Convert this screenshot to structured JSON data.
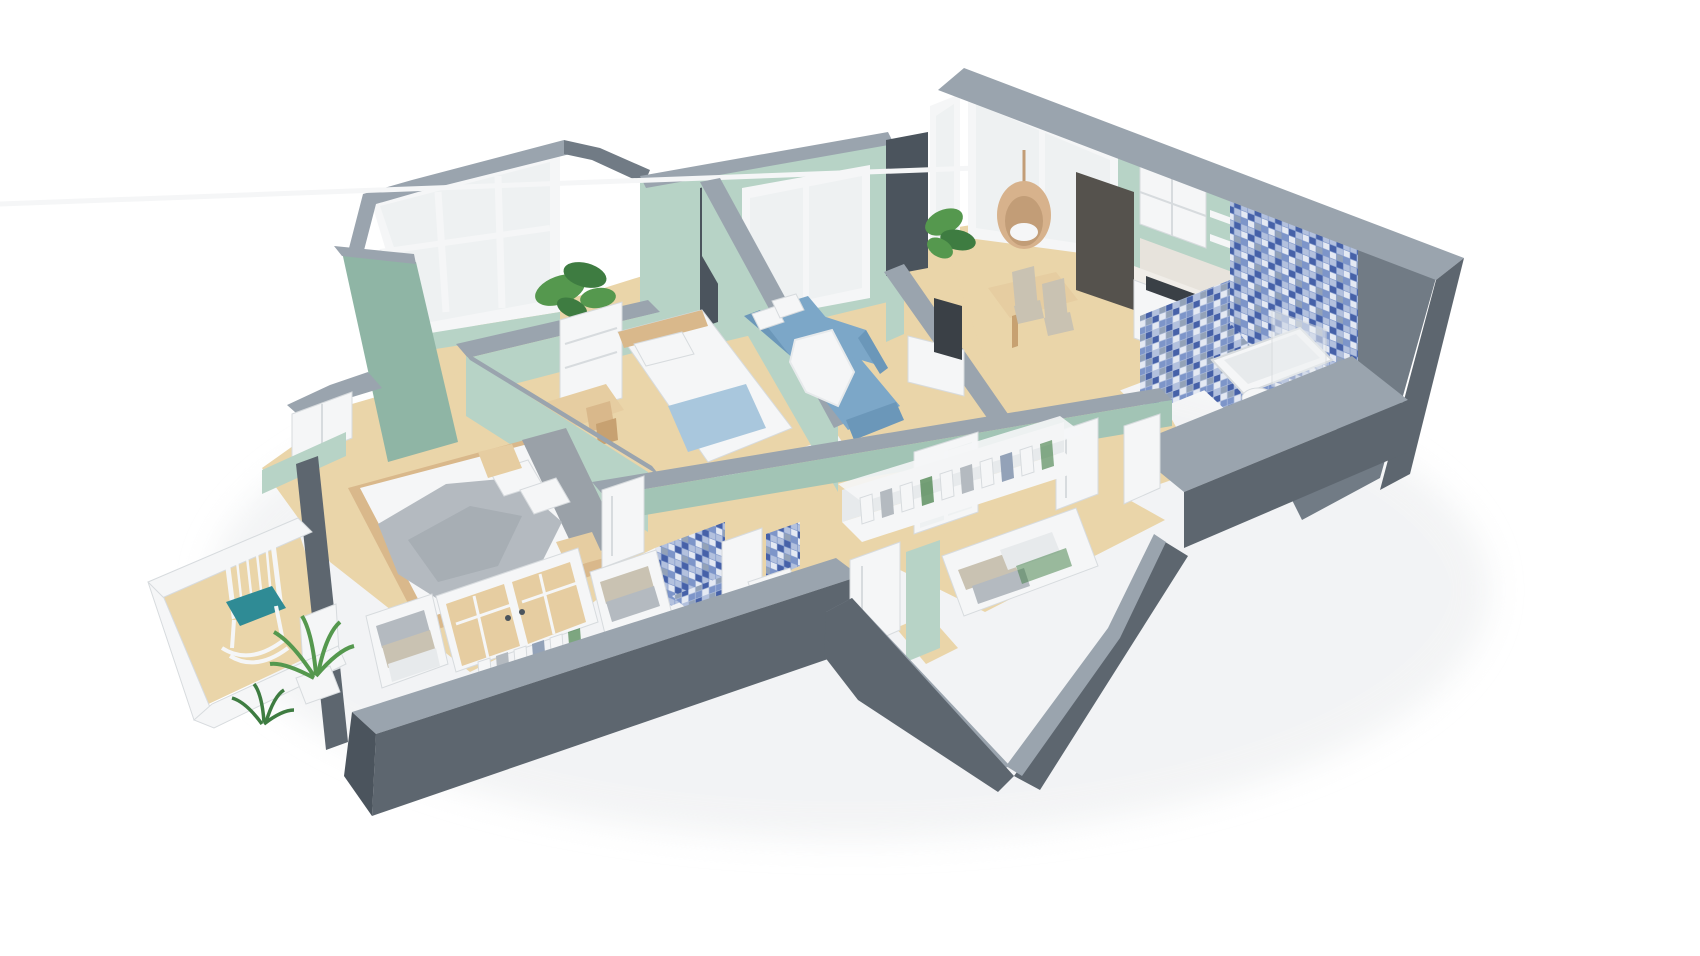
{
  "meta": {
    "title": "3D isometric cutaway floor plan render of an apartment",
    "view": "axonometric bird's-eye, cut walls, white studio background",
    "visible_text": "none"
  },
  "palette": {
    "bg": "#ffffff",
    "shadow": "#e9ebed",
    "wall_top": "#9aa4ae",
    "wall_top_light": "#aab3bc",
    "wall_front": "#5d666f",
    "wall_side": "#717b85",
    "wall_dark": "#4b545d",
    "mint": "#b7d3c6",
    "mint_light": "#c9e0d3",
    "mint_dark": "#a2c4b5",
    "mint_deep": "#8fb5a5",
    "floor": "#ead5a9",
    "floor_dark": "#ddc08f",
    "white": "#f5f6f7",
    "white_dim": "#e7eaec",
    "frame_stroke": "#d7dbde",
    "glass": "#eef1f2",
    "tile1": "#4661a8",
    "tile2": "#7d95c9",
    "tile3": "#b3c1de",
    "tile4": "#e4e9f3",
    "tile5": "#93a2b8",
    "sofa": "#7ca7c8",
    "sofa_dark": "#6b97b9",
    "blue_blanket": "#a9c7dd",
    "blanket": "#b4bac0",
    "blanket_dark": "#9aa1a8",
    "wood": "#d9b88b",
    "wood_light": "#e6cda1",
    "wood_dark": "#c7a171",
    "appliance": "#55524d",
    "tv": "#3a4046",
    "marble": "#e7e3dc",
    "marble_light": "#f0ede8",
    "rattan": "#d7b28c",
    "rattan_dark": "#c29d77",
    "green": "#55984e",
    "green_dark": "#3e7c41",
    "teal": "#2f8b95",
    "beige": "#c9c2b2",
    "gold": "#c9a254"
  },
  "scene": {
    "rooms": [
      {
        "id": "loggia",
        "name": "glazed loggia",
        "furniture": [
          "corner-window",
          "plant",
          "white-dresser"
        ]
      },
      {
        "id": "kids-bedroom",
        "name": "small bedroom",
        "furniture": [
          "single-bed",
          "blue-throw",
          "desk",
          "chair"
        ]
      },
      {
        "id": "living-room",
        "name": "living room",
        "furniture": [
          "blue-sectional-sofa",
          "white-pillows",
          "white-throw",
          "window"
        ]
      },
      {
        "id": "kitchen-dining",
        "name": "kitchen / dining",
        "furniture": [
          "tv",
          "tv-stand",
          "dining-table",
          "two-chairs",
          "hanging-egg-chair",
          "plant",
          "fridge",
          "upper-cabinet",
          "open-shelves",
          "marble-counter",
          "gas-hob",
          "sink",
          "gold-faucet",
          "corner-window"
        ]
      },
      {
        "id": "bathroom",
        "name": "bathroom",
        "furniture": [
          "blue-mosaic-walls",
          "bathtub",
          "glass-screen",
          "toilet"
        ]
      },
      {
        "id": "wc",
        "name": "small shower WC",
        "furniture": [
          "blue-mosaic-wall",
          "tiled-floor",
          "door"
        ]
      },
      {
        "id": "hallway",
        "name": "hallway",
        "furniture": [
          "open-wardrobe-hanging-clothes",
          "french-glass-door",
          "white-doors"
        ]
      },
      {
        "id": "master-bedroom",
        "name": "master bedroom",
        "furniture": [
          "double-bed",
          "grey-throw",
          "pillows",
          "two-nightstands",
          "window-alcove",
          "built-in-closet",
          "glass-closet-doors",
          "folded-linen-niches",
          "hanging-clothes"
        ]
      },
      {
        "id": "entrance",
        "name": "entrance storage",
        "furniture": [
          "open-wardrobe-folded-clothes",
          "door"
        ]
      },
      {
        "id": "balcony",
        "name": "open balcony",
        "furniture": [
          "white-rocking-chair",
          "teal-cushion",
          "two-plants",
          "white-railing",
          "balcony-door"
        ]
      }
    ]
  }
}
